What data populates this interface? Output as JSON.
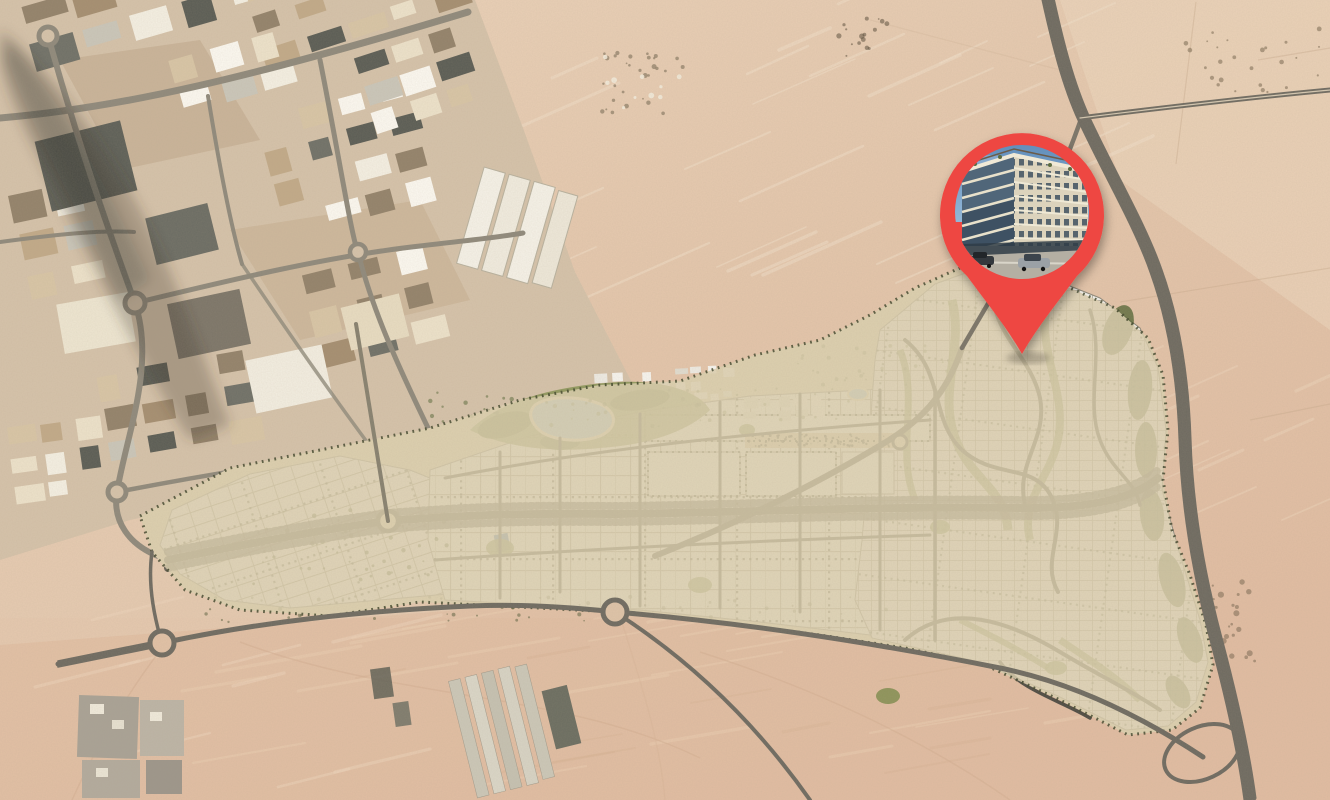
{
  "meta": {
    "view": "satellite-map-with-masterplan-overlay"
  },
  "marker": {
    "name": "property-location-pin",
    "icon": "map-pin-icon",
    "photo_subject": "mid-rise residential building render"
  },
  "map_regions": {
    "industrial_district": "industrial-area-top-left",
    "masterplan": "white-parcel-development",
    "desert": "sand-dunes",
    "highway": "eastern-highway"
  },
  "colors": {
    "sand-base": "#e5c7ac",
    "sand-light": "#eed8c0",
    "sand-pink": "#e2bda2",
    "industrial-ground": "#d6c3aa",
    "road-gray": "#8f897b",
    "road-dark": "#4e4b43",
    "highway-gray": "#6e6a60",
    "plan-ground": "#ddd0af",
    "parcel-white": "#f3f2ee",
    "green-olive": "#8a9557",
    "green-dark": "#5d6b3c",
    "lake-blue": "#a6c8dc",
    "pin-red": "#ee4742",
    "sky-blue": "#6d9ac6",
    "building-cream": "#dcd3bc",
    "glass-dark": "#3e5163"
  }
}
